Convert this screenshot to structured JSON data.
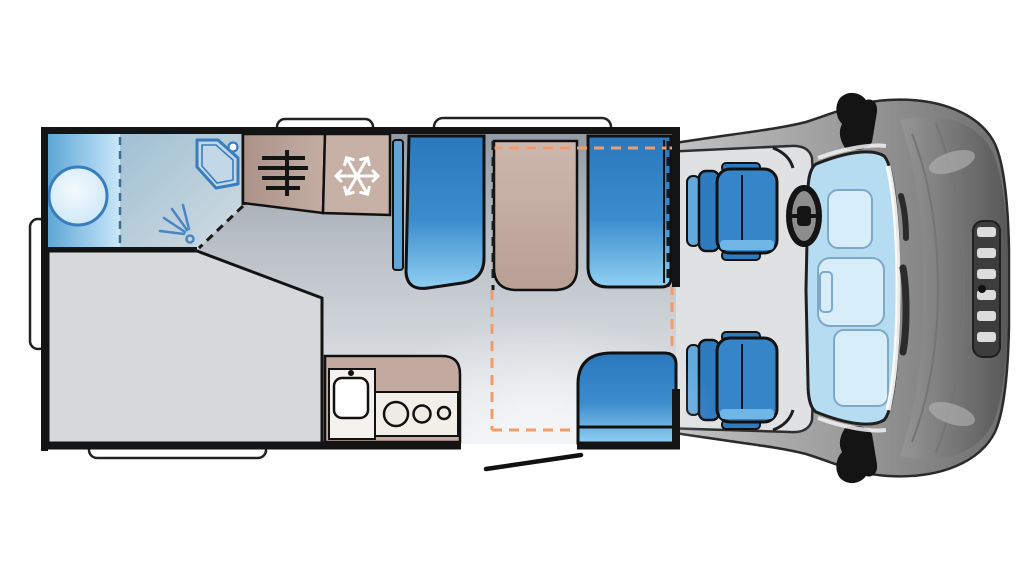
{
  "title": "Motorhome floor plan (top view)",
  "vehicle": {
    "kind": "coachbuilt motorhome floorplan",
    "view": "top-down",
    "front_of_vehicle": "right",
    "rear_of_vehicle": "left"
  },
  "areas": {
    "washroom": {
      "label": "Rear washroom with toilet, corner basin and separate shower",
      "fixtures": [
        "toilet",
        "corner-washbasin",
        "shower"
      ]
    },
    "bed": {
      "label": "Rear french bed"
    },
    "wardrobe": {
      "label": "Wardrobe",
      "icon": "clothes-rail-icon"
    },
    "fridge": {
      "label": "Fridge",
      "icon": "snowflake-icon"
    },
    "dinette": {
      "label": "Half dinette with table and two bench seats",
      "drop_down_bed_marking": "orange dashed rectangle"
    },
    "side_seat": {
      "label": "Side seat next to entrance door"
    },
    "kitchen": {
      "label": "Kitchen block with sink and 3-burner hob",
      "fixtures": [
        "sink",
        "hob-3-burners"
      ]
    },
    "entrance": {
      "label": "Entrance door shown open"
    },
    "cab": {
      "label": "Driver cab with two swivel seats",
      "features": [
        "driver-seat",
        "passenger-seat",
        "steering-wheel",
        "windscreen",
        "wing-mirrors"
      ]
    }
  },
  "exterior": {
    "roof_windows": 2,
    "exterior_hatch": 1,
    "rear_bumper_rail": 1
  },
  "colors": {
    "outline": "#141414",
    "seat_blue_dark": "#2b78bd",
    "seat_blue_light": "#90d0f2",
    "furniture_taupe": "#c2aaa0",
    "wet_area_blue": "#5ea7d6",
    "bath_fixture_stroke": "#3a7dbf",
    "floor_dark": "#939ba4",
    "floor_light": "#edeff1",
    "bed_gray": "#d6d8da",
    "dashed_orange": "#ef9d6d",
    "cab_body_gray": "#9a9a9a",
    "windshield_blue": "#b6dcf2"
  }
}
